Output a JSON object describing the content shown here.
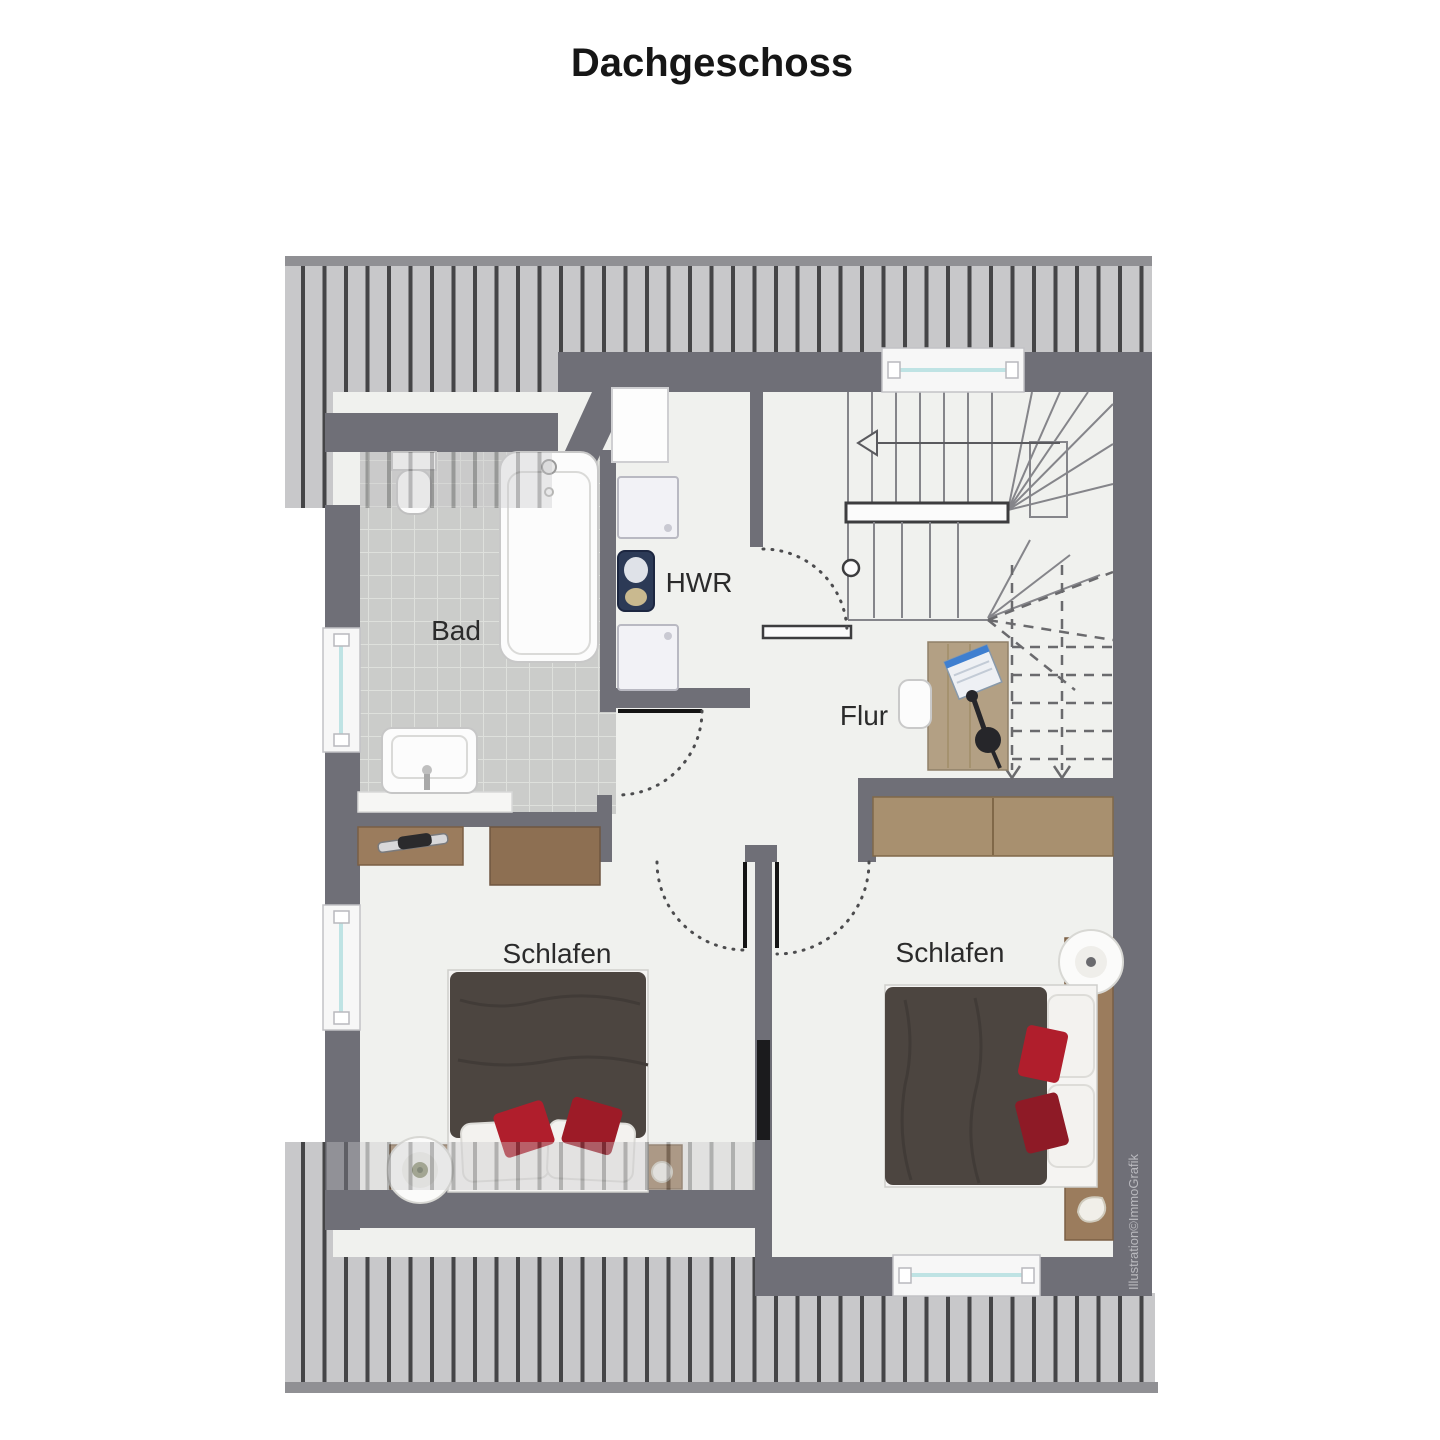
{
  "title": "Dachgeschoss",
  "floor_plan": {
    "rooms": [
      {
        "id": "bad",
        "label": "Bad"
      },
      {
        "id": "hwr",
        "label": "HWR"
      },
      {
        "id": "flur",
        "label": "Flur"
      },
      {
        "id": "schlafen_left",
        "label": "Schlafen"
      },
      {
        "id": "schlafen_right",
        "label": "Schlafen"
      }
    ],
    "watermark": "Illustration©ImmoGrafik",
    "features": [
      "staircase",
      "bathtub",
      "toilet",
      "sink",
      "washing-machines",
      "laundry-basket",
      "desk",
      "double-bed-left",
      "double-bed-right",
      "wardrobe"
    ],
    "window_count": 4
  },
  "colors": {
    "wall": "#6f6f77",
    "roof_hatch_bg": "#c8c8ca",
    "roof_hatch_stripe": "#454547",
    "floor": "#f0f1ee",
    "tile": "#cbccca",
    "wood": "#9b7c5d",
    "bed_duvet": "#4c4540",
    "accent_pillow": "#b01e2c",
    "window_glass": "#bfe3e4"
  }
}
